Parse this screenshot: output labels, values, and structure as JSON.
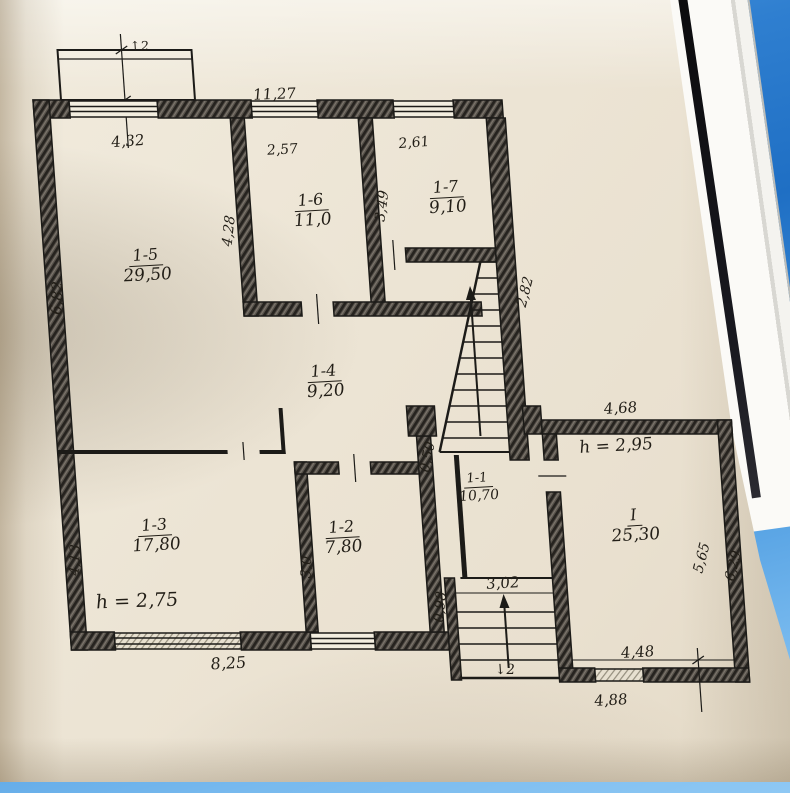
{
  "plan": {
    "rooms": [
      {
        "id": "1-5",
        "area": "29,50"
      },
      {
        "id": "1-6",
        "area": "11,0"
      },
      {
        "id": "1-7",
        "area": "9,10"
      },
      {
        "id": "1-4",
        "area": "9,20"
      },
      {
        "id": "1-3",
        "area": "17,80"
      },
      {
        "id": "1-2",
        "area": "7,80"
      },
      {
        "id": "1-1",
        "area": "10,70"
      },
      {
        "id": "I",
        "area": "25,30"
      }
    ],
    "heights": {
      "main": "h = 2,75",
      "annex": "h = 2,95"
    },
    "dims": {
      "top_overall": "11,27",
      "top_left": "4,32",
      "top_mid": "2,57",
      "top_right": "2,61",
      "left_upper": "6,82",
      "left_lower": "4,13",
      "wall_1_6": "4,28",
      "wall_1_7": "3,49",
      "stair_wall": "2,82",
      "closet": "0,50",
      "wall_1_2": "3,0",
      "porch_side": "0,98",
      "annex_top": "4,68",
      "annex_right_inner": "5,65",
      "annex_right_outer": "6,29",
      "bottom_main": "8,25",
      "landing": "3,02",
      "annex_bottom_inner": "4,48",
      "annex_bottom_outer": "4,88"
    },
    "stairs": {
      "upper_mark": "↑2",
      "lower_mark": "↓2"
    },
    "colors": {
      "ink": "#1c1b18",
      "paper": "#ece4d4",
      "photo_blue": "#2f7fd0"
    }
  }
}
